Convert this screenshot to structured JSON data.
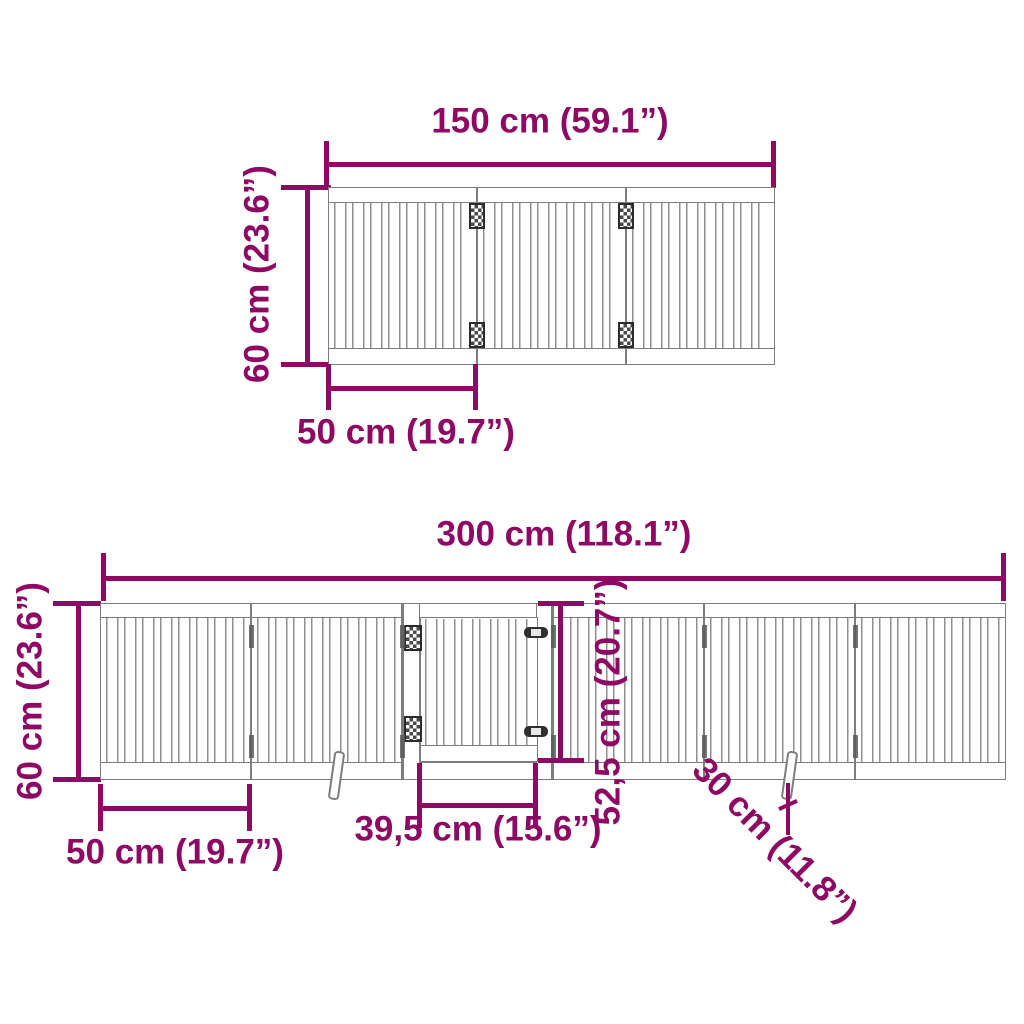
{
  "colors": {
    "dimension": "#8d0963",
    "gate_outline": "#7d7d7d"
  },
  "top_diagram": {
    "description": "foldable gate, 3 panels, top view",
    "panel_count": 3,
    "width_label": "150 cm (59.1”)",
    "height_label": "60 cm (23.6”)",
    "panel_width_label": "50 cm (19.7”)"
  },
  "bottom_diagram": {
    "description": "foldable gate with door, 6 panels, front view",
    "panel_count": 6,
    "width_label": "300 cm (118.1”)",
    "height_label": "60 cm (23.6”)",
    "panel_width_label": "50 cm (19.7”)",
    "door_width_label": "39,5 cm (15.6”)",
    "door_height_label": "52,5 cm (20.7”)",
    "support_foot_label": "30 cm (11.8”)"
  }
}
